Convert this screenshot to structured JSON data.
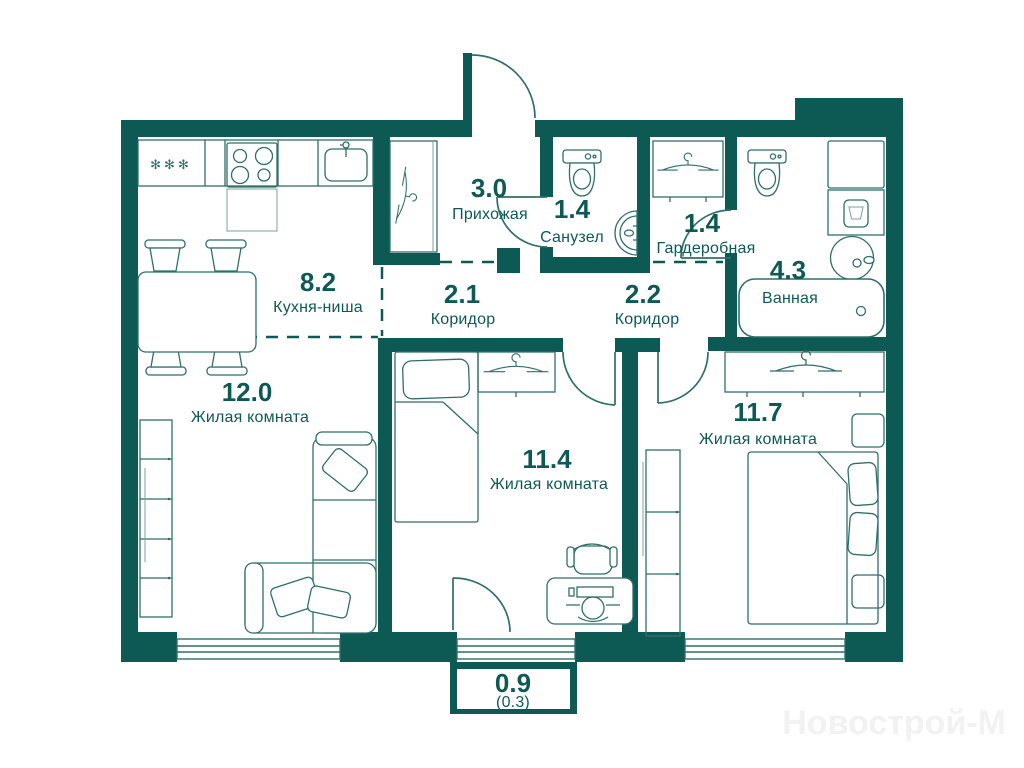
{
  "plan": {
    "watermark": "Новострой-М",
    "kitchen_freezer_symbol": "✻✻✻",
    "colors": {
      "wall": "#0d5a55",
      "line": "#2f6f6a",
      "text": "#0d5a55",
      "watermark": "#f2f2f2"
    },
    "rooms": {
      "hallway": {
        "area": "3.0",
        "name": "Прихожая"
      },
      "wc": {
        "area": "1.4",
        "name": "Санузел"
      },
      "wardrobe": {
        "area": "1.4",
        "name": "Гардеробная"
      },
      "bathroom": {
        "area": "4.3",
        "name": "Ванная"
      },
      "kitchen": {
        "area": "8.2",
        "name": "Кухня-ниша"
      },
      "corridor1": {
        "area": "2.1",
        "name": "Коридор"
      },
      "corridor2": {
        "area": "2.2",
        "name": "Коридор"
      },
      "living1": {
        "area": "12.0",
        "name": "Жилая комната"
      },
      "living2": {
        "area": "11.4",
        "name": "Жилая комната"
      },
      "living3": {
        "area": "11.7",
        "name": "Жилая комната"
      },
      "balcony": {
        "area": "0.9",
        "area_reduced": "(0.3)"
      }
    }
  }
}
